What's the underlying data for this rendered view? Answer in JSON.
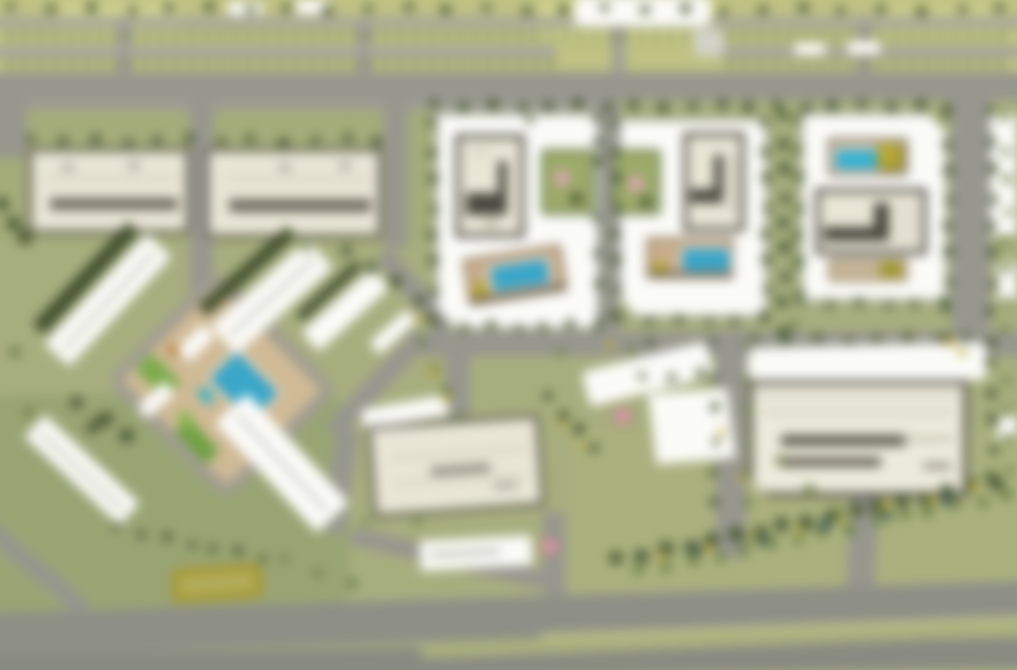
{
  "scene": {
    "type": "architectural-masterplan-aerial-rendering",
    "appearance": "heavily blurred site plan, no legible text",
    "elements": {
      "courtyard_residential_blocks": 4,
      "courtyard_amenity_pools": 3,
      "central_plaza_with_pool": 1,
      "diagonal_row_buildings": 6,
      "flat_cream_buildings": 5,
      "surface_parking_strip_top": true,
      "boulevard_bottom": true,
      "tree_hedgerows": true
    }
  },
  "palette": {
    "grass": "#a7ae7c",
    "grassDark": "#99a471",
    "grassLight": "#aab17c",
    "parking": "#bfc280",
    "parkingLight": "#cdd08b",
    "road": "#97978e",
    "roadLight": "#a6a69b",
    "highway": "#8e8f87",
    "highwayDark": "#898a82",
    "white": "#fbfbf8",
    "cream": "#e9e6d5",
    "outline": "#5a574c",
    "treeDark": "#4a5733",
    "tree": "#6f8047",
    "treeYellow": "#bfae3a",
    "treeTeal": "#3a565c",
    "pool": "#35a8cc",
    "poolBright": "#2db4d6",
    "deckTan": "#c9ae8b",
    "plaza": "#d0ba93",
    "lawn": "#7cac49",
    "pink": "#dba6b2",
    "hedgeYellow": "#a8982b"
  }
}
